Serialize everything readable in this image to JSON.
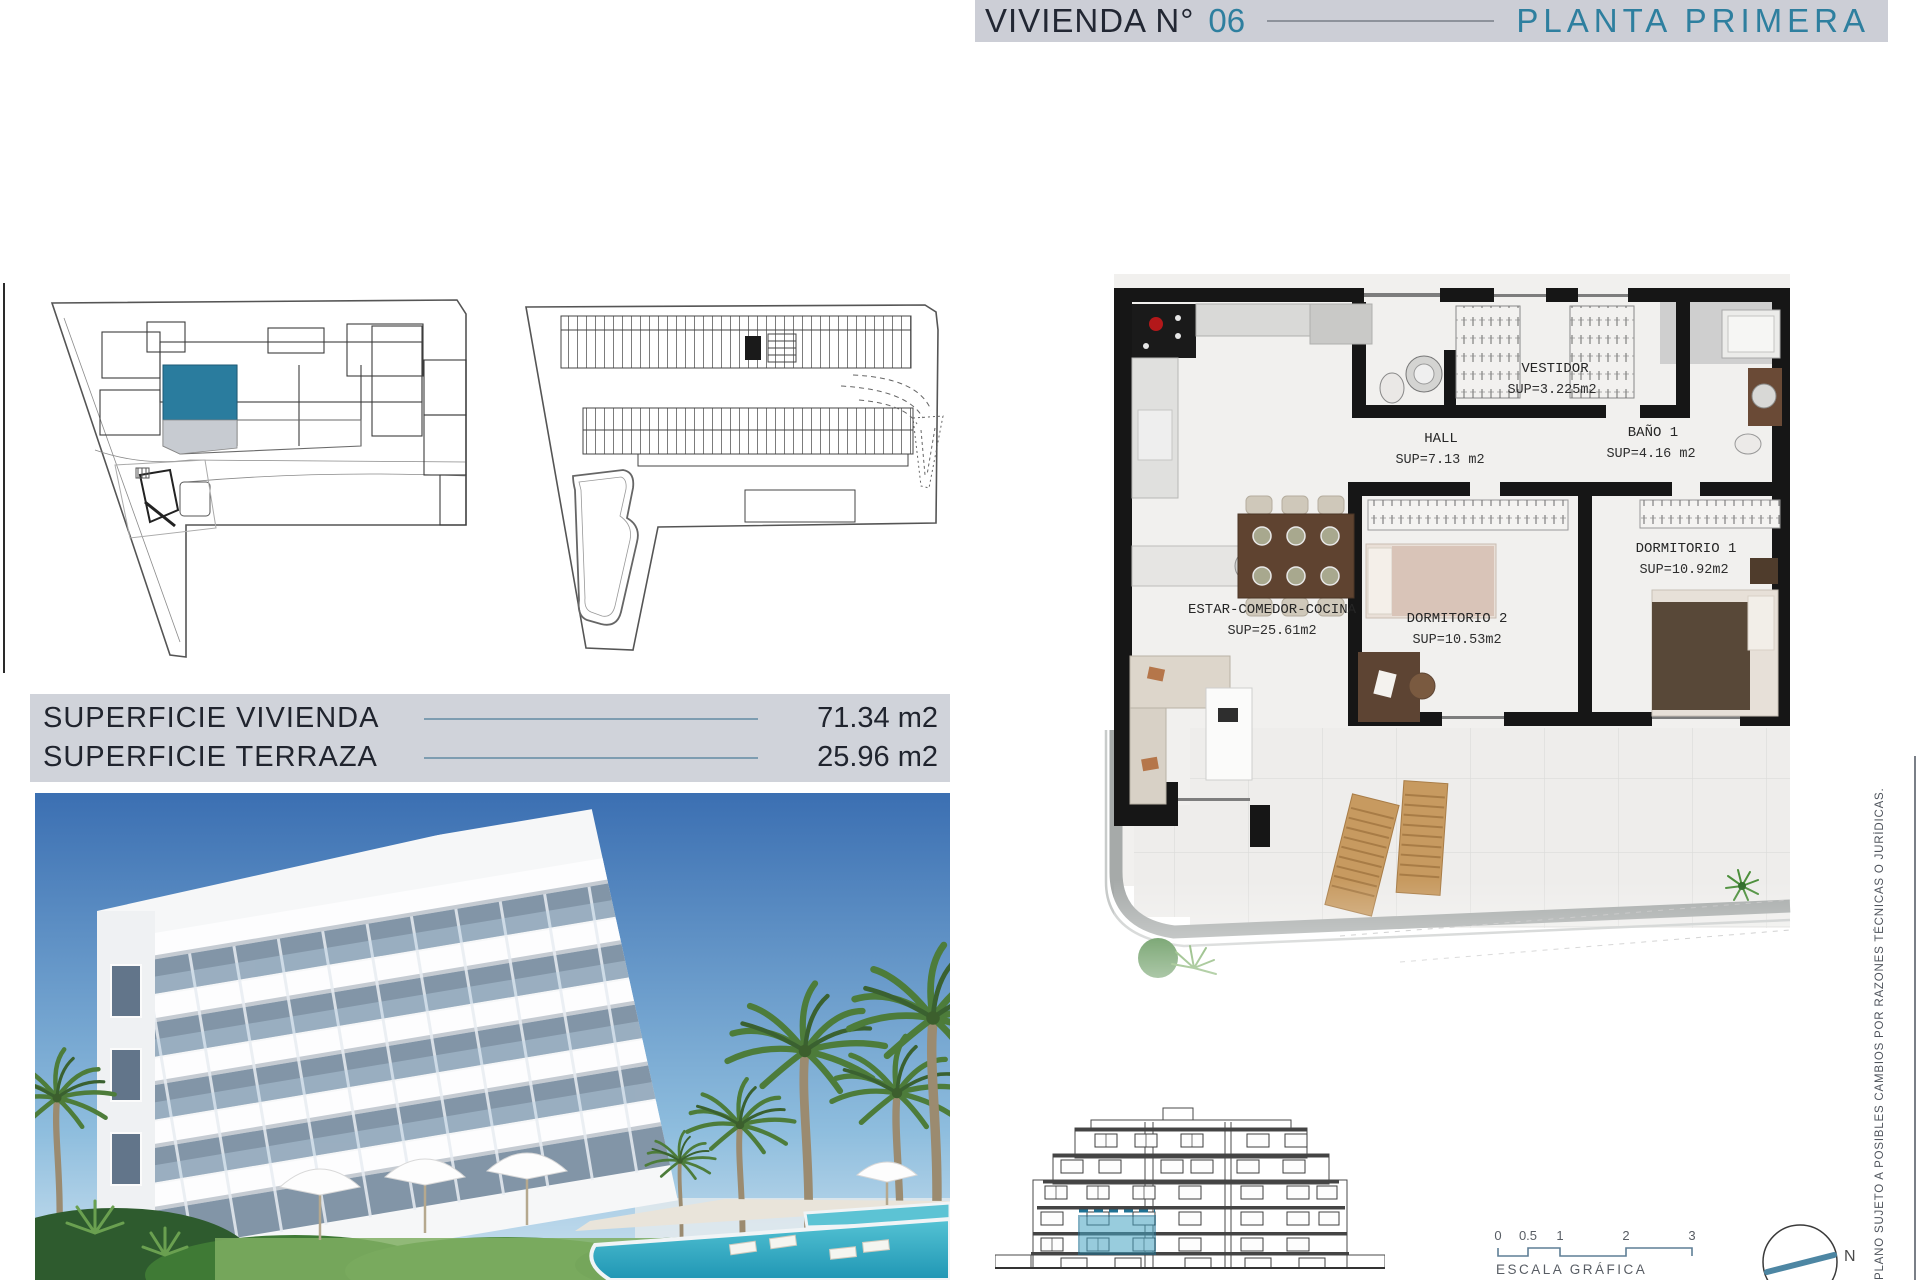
{
  "header": {
    "title_prefix": "VIVIENDA N°",
    "unit_number": "06",
    "title_suffix": "PLANTA PRIMERA"
  },
  "areas_table": {
    "rows": [
      {
        "label": "SUPERFICIE VIVIENDA",
        "value": "71.34 m2"
      },
      {
        "label": "SUPERFICIE TERRAZA",
        "value": "25.96 m2"
      }
    ]
  },
  "floorplan": {
    "rooms": [
      {
        "name": "VESTIDOR",
        "sup": "SUP=3.225m2"
      },
      {
        "name": "HALL",
        "sup": "SUP=7.13 m2"
      },
      {
        "name": "BAÑO 1",
        "sup": "SUP=4.16 m2"
      },
      {
        "name": "DORMITORIO 1",
        "sup": "SUP=10.92m2"
      },
      {
        "name": "DORMITORIO 2",
        "sup": "SUP=10.53m2"
      },
      {
        "name": "ESTAR-COMEDOR-COCINA",
        "sup": "SUP=25.61m2"
      }
    ]
  },
  "scale_bar": {
    "ticks": [
      "0",
      "0.5",
      "1",
      "2",
      "3"
    ],
    "label": "ESCALA GRÁFICA"
  },
  "compass": {
    "north_label": "N"
  },
  "disclaimer": "PLANO SUJETO A POSIBLES CAMBIOS POR RAZONES TÉCNICAS O JURÍDICAS.",
  "colors": {
    "accent_teal": "#2e7f9f",
    "site_unit_teal": "#2a7c9e",
    "header_bg": "#ccced6",
    "table_bg": "#d0d3da",
    "table_line": "#7e9db1",
    "wall_black": "#161616",
    "elevation_highlight": "#45a3c2"
  }
}
